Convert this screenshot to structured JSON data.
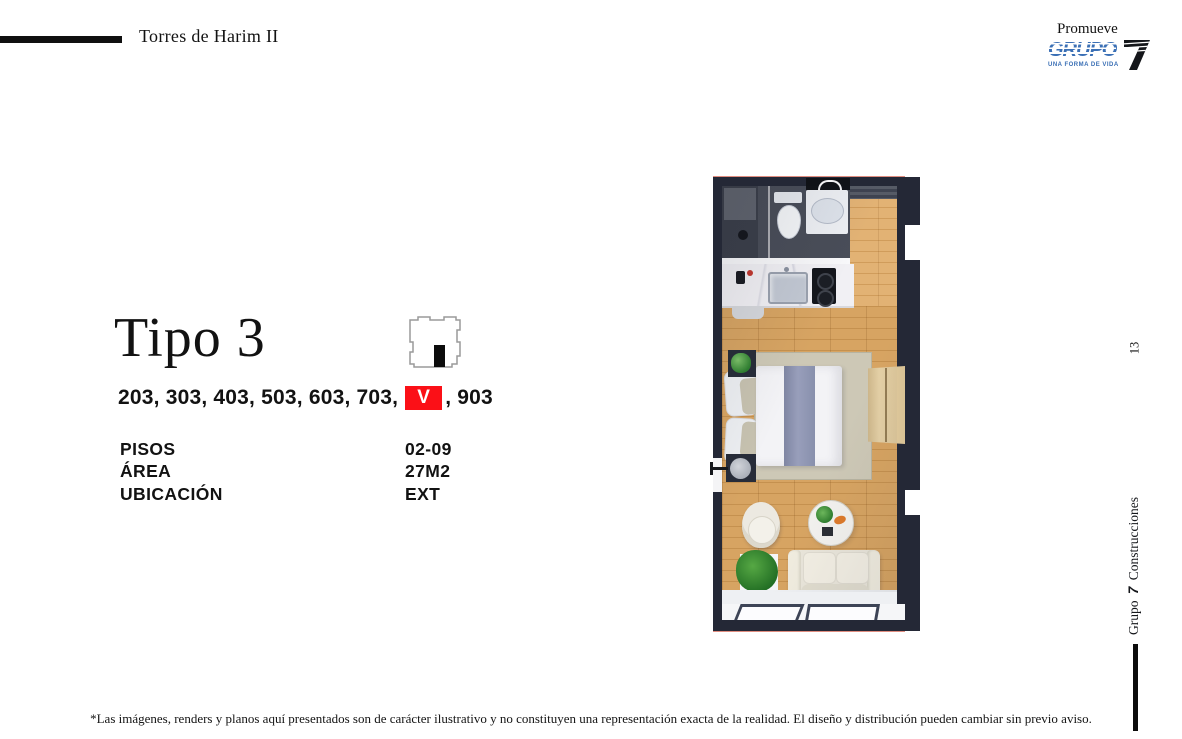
{
  "header": {
    "project_title": "Torres de Harim II",
    "promoter_label": "Promueve",
    "logo": {
      "brand_word": "GRUPO",
      "brand_number": "7",
      "tagline": "UNA FORMA DE VIDA",
      "brand_color": "#3a6fb5"
    }
  },
  "unit": {
    "type_title": "Tipo 3",
    "location_icon": "building-footprint-icon",
    "units_prefix": "203, 303, 403, 503, 603, 703,",
    "sold_marker": "V",
    "units_suffix": ", 903",
    "sold_color": "#fb1017",
    "specs": [
      {
        "label": "PISOS",
        "value": "02-09"
      },
      {
        "label": "ÁREA",
        "value": "27M2"
      },
      {
        "label": "UBICACIÓN",
        "value": "EXT"
      }
    ]
  },
  "sidebar": {
    "page_number": "13",
    "brand_prefix": "Grupo",
    "brand_number": "7",
    "brand_suffix": "Construcciones"
  },
  "footer": {
    "disclaimer": "*Las imágenes, renders y planos aquí presentados son de carácter ilustrativo y no constituyen una representación exacta de la realidad. El diseño y distribución pueden cambiar sin previo aviso."
  },
  "floorplan": {
    "description": "Top-down 3D render of studio apartment Tipo 3",
    "colors": {
      "wall": "#242836",
      "wood_floor": "#d3a05e",
      "bathroom_tile": "#494d58",
      "rug": "#cdc8b6"
    },
    "elements": [
      "exterior-walls",
      "bathroom",
      "shower",
      "toilet",
      "sink-vanity",
      "towel-shelf",
      "entry-door",
      "kitchen-counter",
      "kitchen-sink",
      "cooktop",
      "stool",
      "wood-floor",
      "area-rug",
      "double-bed",
      "pillows",
      "throw-blanket",
      "nightstand",
      "table-lamp",
      "floor-lamp",
      "wardrobe",
      "armchair",
      "round-table",
      "table-plant",
      "sofa",
      "floor-plant",
      "window-wall",
      "balcony-sill"
    ]
  }
}
